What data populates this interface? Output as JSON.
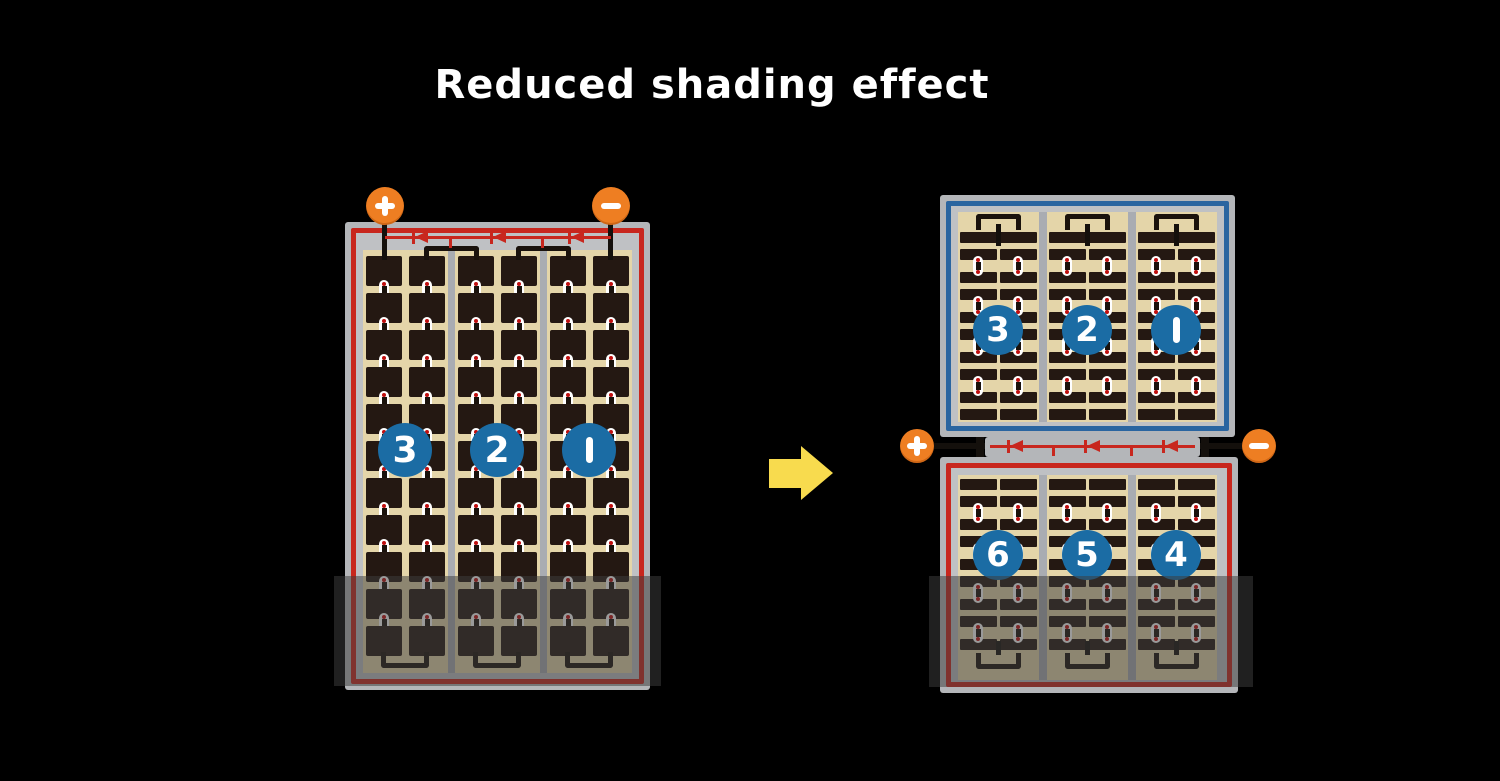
{
  "title": "Reduced shading effect",
  "left_module": {
    "terminals": {
      "plus": "+",
      "minus": "−"
    },
    "string_labels": [
      "3",
      "2",
      "1"
    ]
  },
  "right_module": {
    "terminals": {
      "plus": "+",
      "minus": "−"
    },
    "top_string_labels": [
      "3",
      "2",
      "1"
    ],
    "bottom_string_labels": [
      "6",
      "5",
      "4"
    ]
  },
  "colors": {
    "background": "#000000",
    "title_text": "#FFFFFF",
    "frame_gray": "#B4B6B9",
    "module_red": "#C8271E",
    "module_blue": "#2A65A0",
    "cell_tan": "#E4D5A9",
    "cell_dark": "#241812",
    "divider_gray": "#A9ACB2",
    "terminal_orange": "#EE7E22",
    "number_circle_blue": "#1B6CA4",
    "arrow_yellow": "#F8DB4E",
    "diode_red": "#C8271E"
  }
}
